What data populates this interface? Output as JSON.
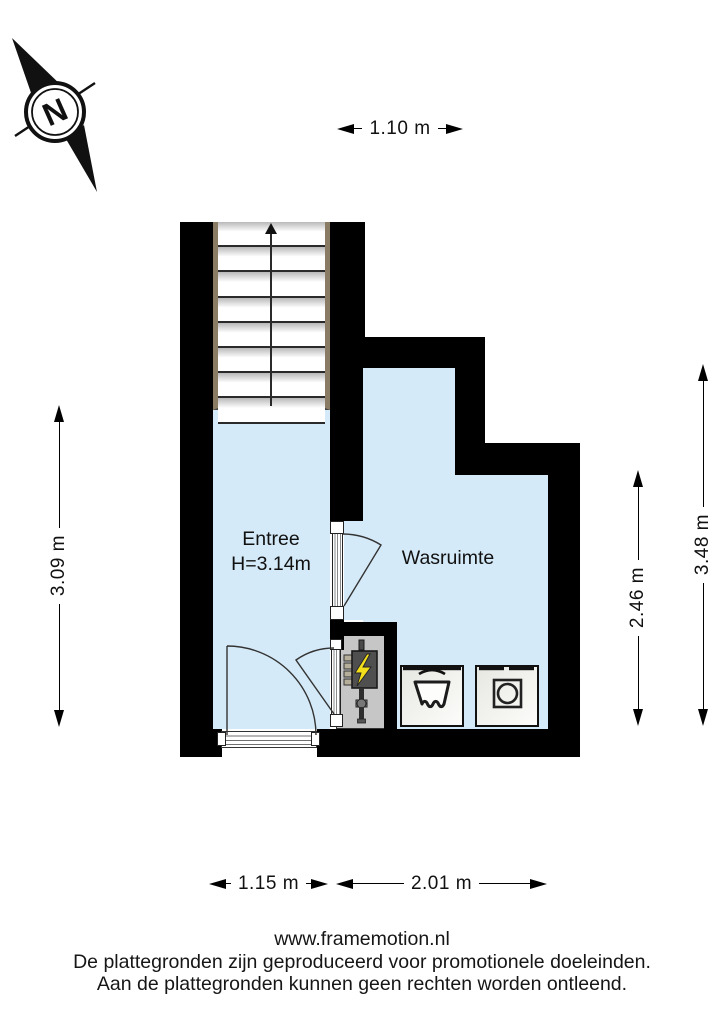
{
  "compass": {
    "label": "N"
  },
  "rooms": {
    "entree": {
      "name": "Entree",
      "height": "H=3.14m"
    },
    "wasruimte": {
      "name": "Wasruimte"
    }
  },
  "dimensions": {
    "stairs_width": "1.10 m",
    "entree_height": "3.09 m",
    "wasruimte_height": "2.46 m",
    "total_height": "3.48 m",
    "entree_width": "1.15 m",
    "wasruimte_width": "2.01 m"
  },
  "fixtures": {
    "stairs": "stairs-up-arrow",
    "electrical_panel": "electrical-meter",
    "sink": "laundry-sink",
    "washer": "washing-machine"
  },
  "footer": {
    "website": "www.framemotion.nl",
    "disclaimer_line1": "De plattegronden zijn geproduceerd voor promotionele doeleinden.",
    "disclaimer_line2": "Aan de plattegronden kunnen geen rechten worden ontleend."
  },
  "colors": {
    "floor": "#d5eaf8",
    "wall": "#000000",
    "closet": "#c6c6c6",
    "lightning": "#f2de1a",
    "stringer": "#8a7c64"
  }
}
